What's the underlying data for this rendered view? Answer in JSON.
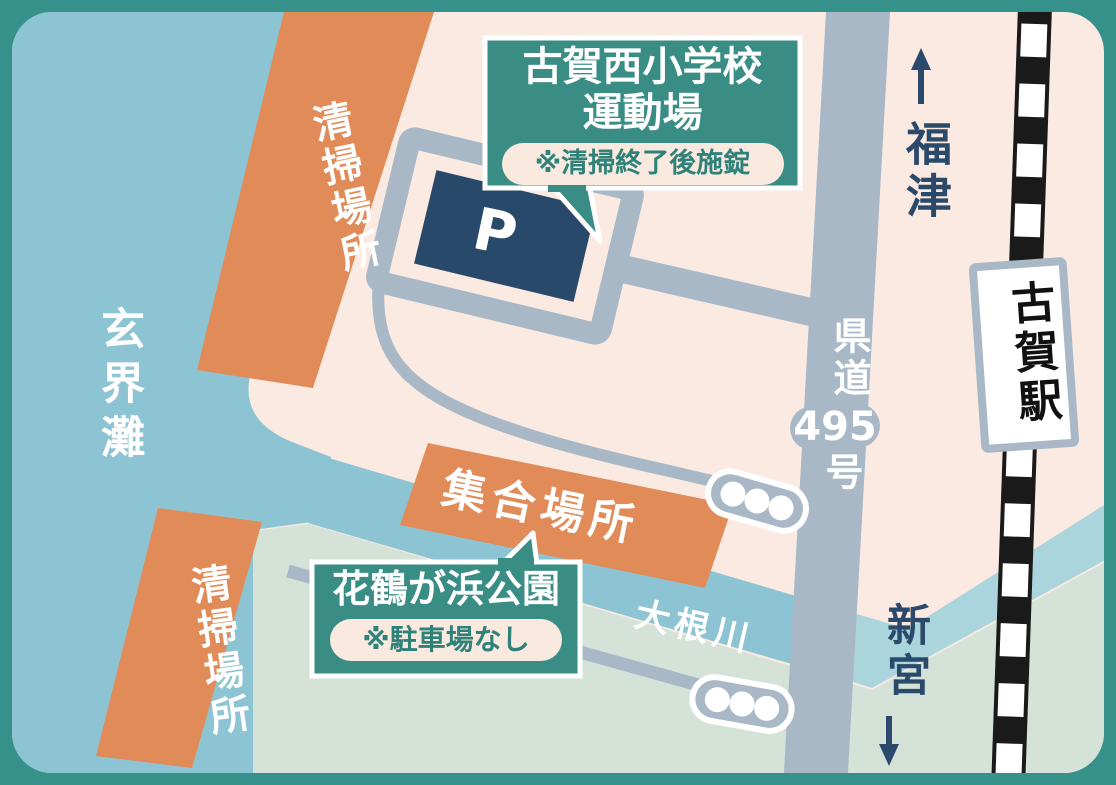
{
  "map": {
    "sea": "玄界灘",
    "cleaning_site_north": "清掃場所",
    "cleaning_site_south": "清掃場所",
    "meeting_point": "集合場所",
    "parking": "P",
    "river": "大根川",
    "route": {
      "prefix": "県道",
      "number": "495",
      "suffix": "号"
    },
    "toward_north": "福津",
    "toward_south": "新宮",
    "station": "古賀駅",
    "school_callout": {
      "line1": "古賀西小学校",
      "line2": "運動場",
      "note": "※清掃終了後施錠"
    },
    "park_callout": {
      "title": "花鶴が浜公園",
      "note": "※駐車場なし"
    }
  },
  "colors": {
    "frame_teal": "#35918a",
    "land_cream": "#faeae1",
    "sea_blue": "#8dc4d3",
    "river_light_blue": "#abd5dd",
    "park_green": "#d5e2d8",
    "site_orange": "#e18b58",
    "road_gray": "#a8b8c7",
    "parking_navy": "#29496b",
    "callout_teal": "#3a8d85",
    "badge_cream": "#f9e9de",
    "rail_black": "#1a1a1a",
    "text_navy": "#2b4a6b",
    "white": "#ffffff"
  }
}
